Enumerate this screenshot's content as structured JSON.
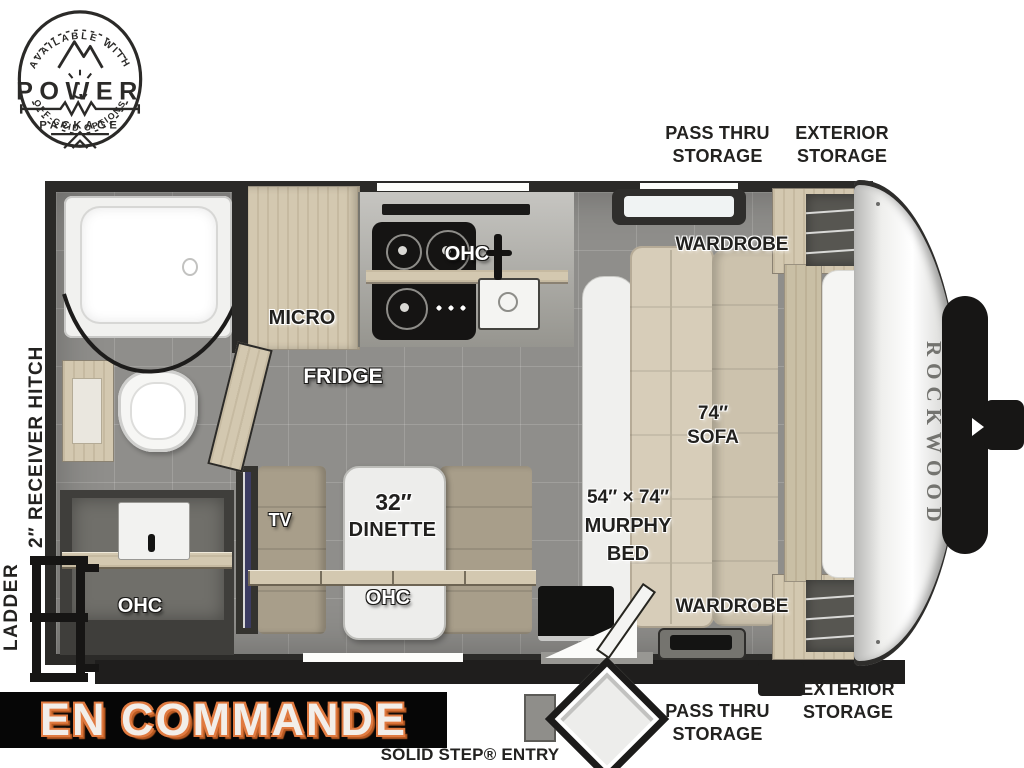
{
  "badge": {
    "arc_top": "AVAILABLE WITH",
    "title": "POWER",
    "subtitle": "PACKAGE",
    "arc_bottom": "OFF-GRID OPTIONS"
  },
  "brand": {
    "front_cap": "ROCKWOOD"
  },
  "banner": {
    "text": "EN COMMANDE"
  },
  "exterior_labels": {
    "top_pass_thru": [
      "PASS THRU",
      "STORAGE"
    ],
    "top_exterior": [
      "EXTERIOR",
      "STORAGE"
    ],
    "bottom_pass_thru": [
      "PASS THRU",
      "STORAGE"
    ],
    "bottom_exterior": [
      "EXTERIOR",
      "STORAGE"
    ],
    "receiver_hitch": "2″ RECEIVER HITCH",
    "ladder": "LADDER",
    "solid_step_entry": "SOLID STEP® ENTRY"
  },
  "room_labels": {
    "micro": "MICRO",
    "fridge": "FRIDGE",
    "kitchen_ohc": "OHC",
    "bath_ohc": "OHC",
    "dinette_ohc": "OHC",
    "tv": "TV",
    "dinette_size": "32″",
    "dinette_name": "DINETTE",
    "sofa_size": "74″",
    "sofa_name": "SOFA",
    "murphy_size": "54″ × 74″",
    "murphy_name": "MURPHY",
    "murphy_bed": "BED",
    "wardrobe_top": "WARDROBE",
    "wardrobe_bottom": "WARDROBE"
  },
  "colors": {
    "banner_bg": "#060606",
    "banner_text": "#f2eee9",
    "banner_outline": "#e07a40",
    "wall": "#2b2a28",
    "floor": "#8f8e8b",
    "cabinet_wood": "#d3c8b0",
    "cushion": "#a89e8a",
    "sofa": "#d7cdb9",
    "label_dark": "#21201e"
  }
}
